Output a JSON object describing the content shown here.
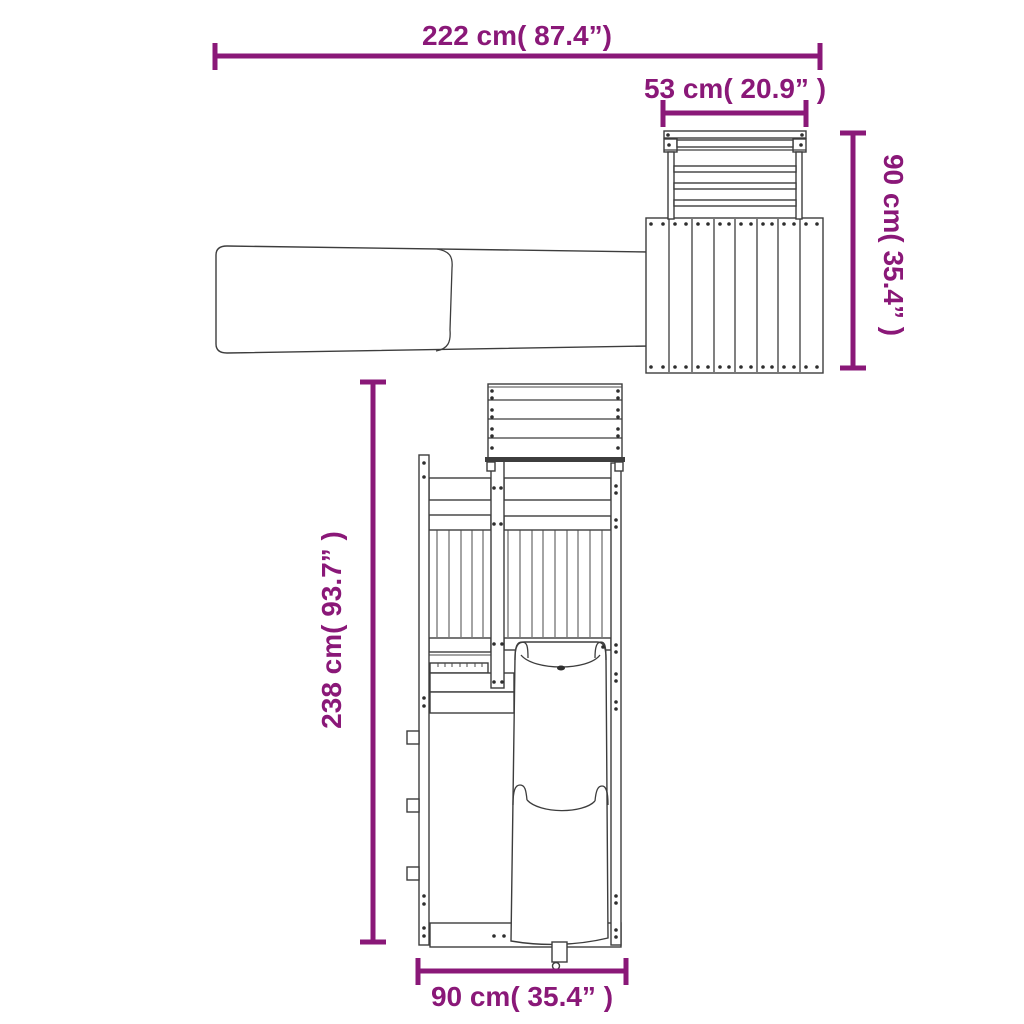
{
  "canvas": {
    "background": "#ffffff",
    "width_px": 1024,
    "height_px": 1024
  },
  "accent_color": "#8a1878",
  "line_color": "#3d3d3d",
  "dimensions": {
    "overall_width": {
      "label": "222 cm( 87.4”)"
    },
    "roof_width": {
      "label": "53 cm( 20.9” )"
    },
    "roof_side_height": {
      "label": "90 cm( 35.4” )"
    },
    "overall_height": {
      "label": "238 cm( 93.7” )"
    },
    "base_width": {
      "label": "90 cm( 35.4” )"
    }
  }
}
